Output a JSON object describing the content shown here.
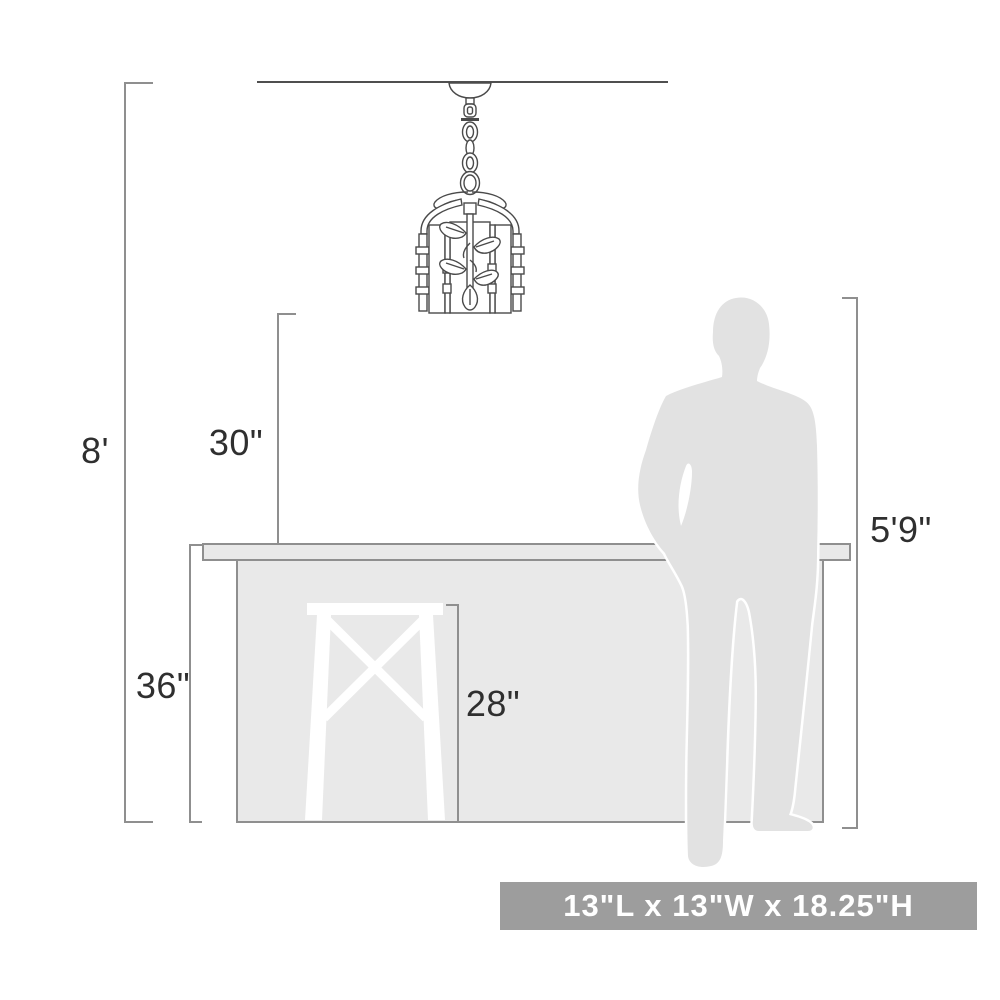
{
  "diagram": {
    "type": "product-dimension-diagram",
    "product": {
      "name": "caged mini pendant light with leaf vine motif",
      "size_badge": "13\"L x 13\"W x 18.25\"H"
    },
    "dimensions": {
      "ceiling_height": "8'",
      "fixture_clearance": "30\"",
      "counter_height": "36\"",
      "stool_height": "28\"",
      "person_height": "5'9\""
    },
    "colors": {
      "badge_bg": "#9d9d9d",
      "badge_text": "#ffffff",
      "silhouette_fill": "#e2e2e2",
      "counter_fill": "#e9e9e9",
      "stool_fill": "#ffffff",
      "dimension_line": "#8f8f8f",
      "ceiling_line": "#4f4f4f",
      "fixture_line": "#4a4a4a",
      "label_text": "#2f2f2f"
    }
  }
}
